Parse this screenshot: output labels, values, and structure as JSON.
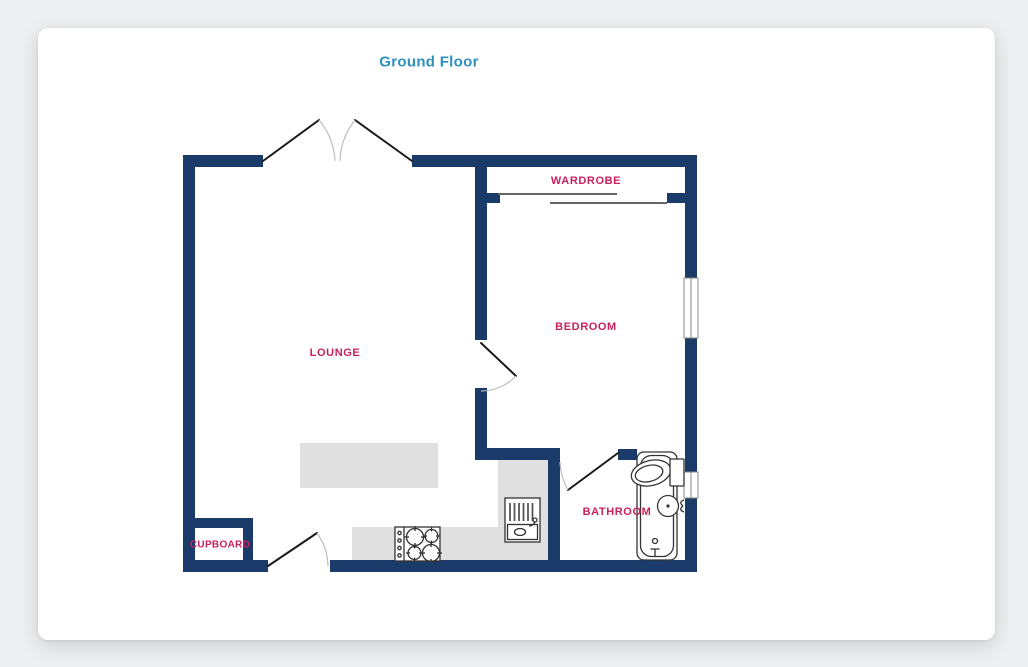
{
  "title": "Ground Floor",
  "rooms": [
    {
      "name": "lounge",
      "label": "LOUNGE"
    },
    {
      "name": "bedroom",
      "label": "BEDROOM"
    },
    {
      "name": "wardrobe",
      "label": "WARDROBE"
    },
    {
      "name": "bathroom",
      "label": "BATHROOM"
    },
    {
      "name": "cupboard",
      "label": "CUPBOARD"
    }
  ],
  "fixtures": {
    "entry": "double-french-door",
    "doors": [
      "bedroom-door",
      "kitchen-door",
      "bathroom-door"
    ],
    "wardrobe": "sliding-doors",
    "windows": [
      "bedroom-window",
      "bathroom-window"
    ],
    "kitchen": [
      "hob-4-burners",
      "sink-with-drainer",
      "l-shaped-counter",
      "island-counter"
    ],
    "bathroom": [
      "bathtub",
      "toilet",
      "basin"
    ]
  },
  "colors": {
    "wall": "#1a3a69",
    "room_label": "#c9205e",
    "title": "#2e8fc0",
    "counter": "#e0e0e0",
    "fixture_outline": "#333333",
    "door_leaf": "#1a1a1a",
    "door_arc": "#bdbdbd",
    "window_frame": "#888888",
    "sliding_door": "#666666",
    "page_background": "#eeeff0",
    "card_background": "#ffffff"
  }
}
